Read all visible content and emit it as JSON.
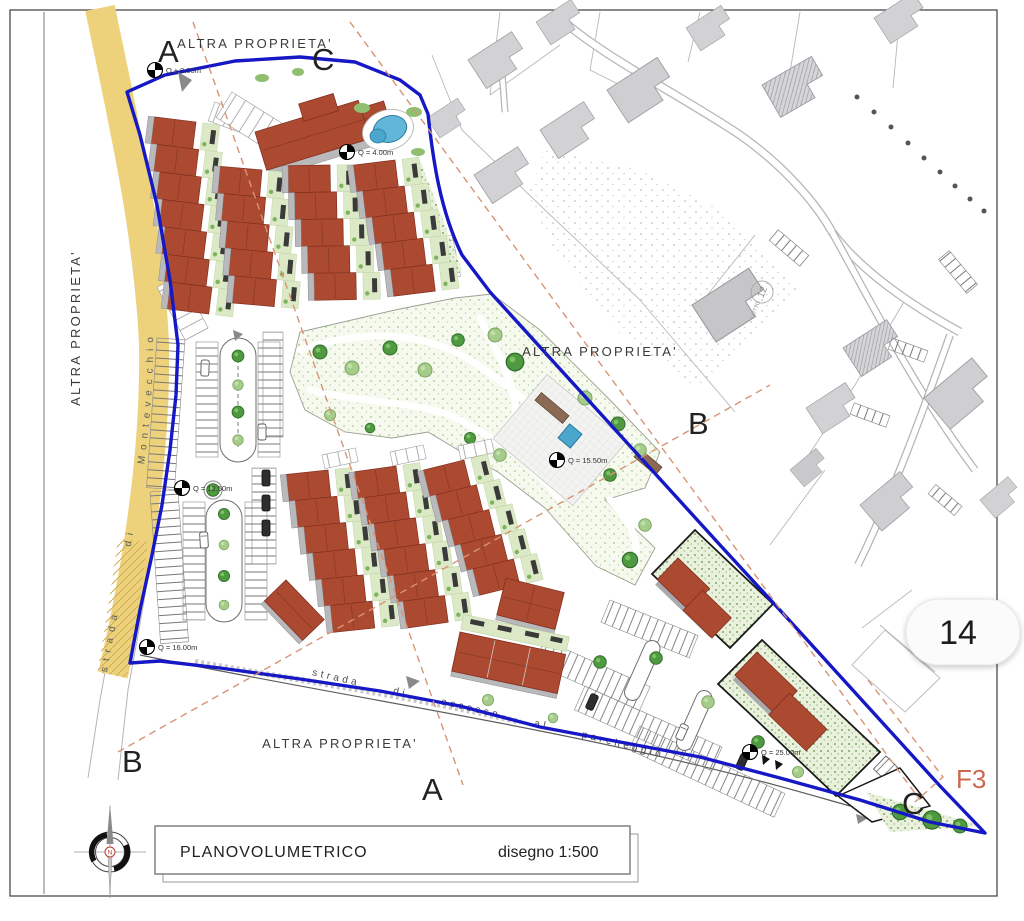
{
  "title_block": {
    "title": "PLANOVOLUMETRICO",
    "scale": "disegno 1:500"
  },
  "compass": {
    "north_label": "N"
  },
  "page_badge": "14",
  "zone_label": "F3",
  "section_markers": {
    "a_top": "A",
    "c_top": "C",
    "b_right": "B",
    "b_bottom_left": "B",
    "a_bottom": "A",
    "c_bottom_right": "C"
  },
  "property_labels": {
    "north": "ALTRA PROPRIETA'",
    "west": "ALTRA PROPRIETA'",
    "east": "ALTRA PROPRIETA'",
    "south": "ALTRA PROPRIETA'"
  },
  "road_labels": {
    "west_road": "strada di Montevecchio",
    "south_road": "strada di accesso al parcheggio"
  },
  "context_labels": {
    "lot_word": "LOTTO",
    "lot_number": "12"
  },
  "elevation_markers": {
    "m1": "Q ± 0.00m",
    "m2": "Q = 4.00m",
    "m3": "Q = 12.50m",
    "m4": "Q = 15.50m",
    "m5": "Q = 16.00m",
    "m6": "Q = 25.00m"
  },
  "colors": {
    "site_boundary": "#1518c4",
    "roof_red": "#ac4a31",
    "road_yellow": "#eed27b",
    "section_line": "#d79474",
    "zone_label_color": "#cc6a4f"
  }
}
